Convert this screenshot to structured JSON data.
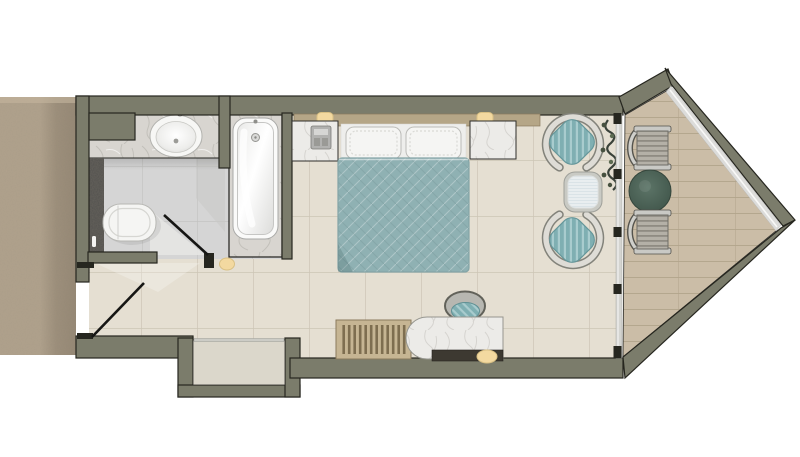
{
  "meta": {
    "type": "architectural-floor-plan",
    "subject": "hotel-guest-room-top-view",
    "visible_text": "none"
  },
  "palette": {
    "wall": "#7b7c6b",
    "wall-outline": "#26261f",
    "floor-main": "#e5dfd2",
    "grout-main": "#ccc5b5",
    "floor-bath": "#d5d5d5",
    "grout-bath": "#c1c1bf",
    "hallway-carpet": "#b1a28c",
    "balcony-floor": "#cbbda7",
    "balcony-line": "#b2a48c",
    "marble-light": "#ecebe8",
    "marble-gray": "#d8d5d0",
    "duvet-teal": "#8fb1b3",
    "cushion-teal": "#7fafb2",
    "seat-gray": "#b4b0a7",
    "headboard-wood": "#b5a687",
    "lamp-cream": "#f3d9a0",
    "table-green": "#4e6458",
    "glass": "#d4d4d0",
    "dark-feature": "#52514e",
    "niche-floor": "#dbd7cb",
    "bench-wood": "#c6b593",
    "slat-dark": "#7e6e50"
  },
  "rooms": {
    "hallway": {
      "items": [
        "carpet"
      ]
    },
    "bathroom": {
      "items": [
        "vanity-counter",
        "sink",
        "faucet",
        "dark-feature-wall",
        "toilet",
        "bathtub",
        "door-swing"
      ]
    },
    "entry": {
      "items": [
        "entry-door-swing",
        "wall-niche",
        "wall-sconce"
      ]
    },
    "bedroom": {
      "items": [
        "headboard",
        "wall-lamp-left",
        "wall-lamp-right",
        "nightstand-left",
        "telephone",
        "nightstand-right",
        "double-bed",
        "pillow-left",
        "pillow-right",
        "lounge-chair-top",
        "lounge-chair-bottom",
        "side-table",
        "plant",
        "luggage-bench",
        "desk",
        "tv-console",
        "desk-chair",
        "wall-sconce"
      ]
    },
    "balcony": {
      "items": [
        "glass-partition",
        "window-wall",
        "armchair-top",
        "armchair-bottom",
        "round-table"
      ]
    }
  }
}
